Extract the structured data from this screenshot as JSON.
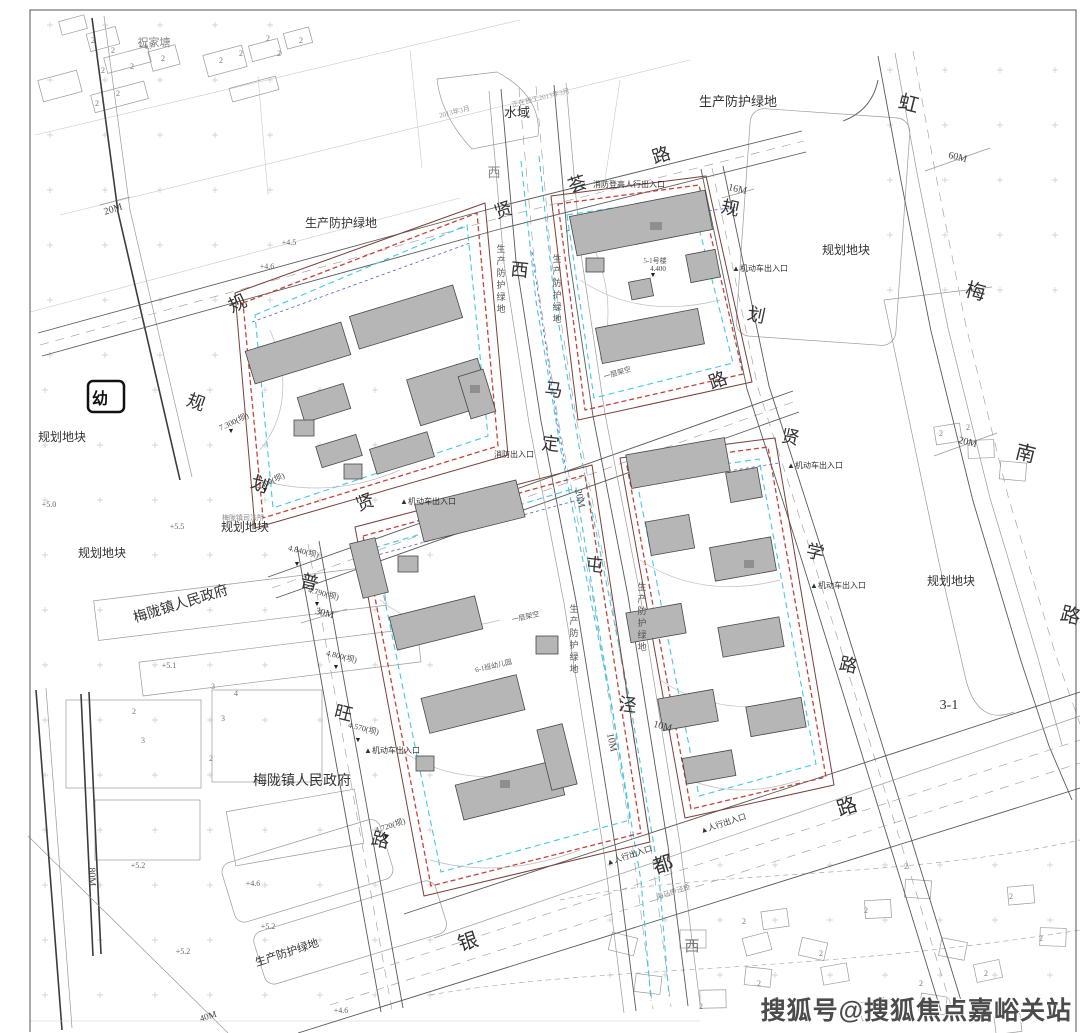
{
  "title": "住宅小区规划总平面图",
  "colors": {
    "ink": "#333333",
    "red": "#c0453a",
    "boundary": "#7a4038",
    "cyan": "#45c7e2",
    "blue": "#4a5fd0",
    "bfill": "#b6b6b6",
    "bstroke": "#474747",
    "road": "#5a5a5a",
    "ctx": "#9a9a9a",
    "faint": "#c9c9c9",
    "frame": "#555555",
    "wm": "#4b4b4b"
  },
  "watermark": {
    "text": "搜狐号@搜狐焦点嘉峪关站"
  },
  "kindergarten_marker": {
    "label": "幼"
  },
  "map": {
    "labels": {
      "road_name_characters": [
        {
          "t": "贤",
          "x": 505,
          "y": 216,
          "s": 18,
          "rot": -18
        },
        {
          "t": "荟",
          "x": 579,
          "y": 190,
          "s": 18,
          "rot": -18
        },
        {
          "t": "路",
          "x": 663,
          "y": 161,
          "s": 18,
          "rot": -18
        },
        {
          "t": "西",
          "x": 494,
          "y": 177,
          "s": 13,
          "c": "#888888"
        },
        {
          "t": "西",
          "x": 519,
          "y": 276,
          "s": 18,
          "rot": 6
        },
        {
          "t": "马",
          "x": 553,
          "y": 396,
          "s": 18,
          "rot": 6
        },
        {
          "t": "定",
          "x": 550,
          "y": 450,
          "s": 18,
          "rot": 6
        },
        {
          "t": "屯",
          "x": 594,
          "y": 571,
          "s": 18,
          "rot": 6
        },
        {
          "t": "泾",
          "x": 627,
          "y": 711,
          "s": 18,
          "rot": 6
        },
        {
          "t": "规",
          "x": 729,
          "y": 214,
          "s": 18,
          "rot": 12
        },
        {
          "t": "划",
          "x": 755,
          "y": 321,
          "s": 18,
          "rot": 12
        },
        {
          "t": "路",
          "x": 720,
          "y": 386,
          "s": 18,
          "rot": -20
        },
        {
          "t": "贤",
          "x": 789,
          "y": 443,
          "s": 18,
          "rot": 12
        },
        {
          "t": "学",
          "x": 814,
          "y": 558,
          "s": 18,
          "rot": 12
        },
        {
          "t": "路",
          "x": 847,
          "y": 671,
          "s": 18,
          "rot": 12
        },
        {
          "t": "贤",
          "x": 367,
          "y": 508,
          "s": 18,
          "rot": -20
        },
        {
          "t": "普",
          "x": 308,
          "y": 588,
          "s": 18,
          "rot": 14
        },
        {
          "t": "旺",
          "x": 342,
          "y": 719,
          "s": 18,
          "rot": 14
        },
        {
          "t": "路",
          "x": 379,
          "y": 846,
          "s": 18,
          "rot": 14
        },
        {
          "t": "规",
          "x": 240,
          "y": 309,
          "s": 18,
          "rot": -25
        },
        {
          "t": "规",
          "x": 194,
          "y": 408,
          "s": 18,
          "rot": 20
        },
        {
          "t": "划",
          "x": 258,
          "y": 490,
          "s": 18,
          "rot": 20
        },
        {
          "t": "虹",
          "x": 907,
          "y": 110,
          "s": 20,
          "rot": 14
        },
        {
          "t": "梅",
          "x": 974,
          "y": 298,
          "s": 20,
          "rot": 14
        },
        {
          "t": "南",
          "x": 1024,
          "y": 460,
          "s": 20,
          "rot": 14
        },
        {
          "t": "路",
          "x": 1069,
          "y": 622,
          "s": 20,
          "rot": 14
        },
        {
          "t": "银",
          "x": 470,
          "y": 948,
          "s": 20,
          "rot": -18
        },
        {
          "t": "都",
          "x": 665,
          "y": 871,
          "s": 20,
          "rot": -18
        },
        {
          "t": "路",
          "x": 849,
          "y": 813,
          "s": 20,
          "rot": -18
        },
        {
          "t": "西",
          "x": 692,
          "y": 951,
          "s": 15,
          "c": "#777777"
        }
      ],
      "area_labels": [
        {
          "t": "水域",
          "x": 517,
          "y": 117,
          "s": 13
        },
        {
          "t": "生产防护绿地",
          "x": 738,
          "y": 106,
          "s": 13
        },
        {
          "t": "生产防护绿地",
          "x": 341,
          "y": 227,
          "s": 12
        },
        {
          "t": "规划地块",
          "x": 62,
          "y": 441,
          "s": 12
        },
        {
          "t": "规划地块",
          "x": 102,
          "y": 557,
          "s": 12
        },
        {
          "t": "规划地块",
          "x": 245,
          "y": 531,
          "s": 12
        },
        {
          "t": "规划地块",
          "x": 846,
          "y": 254,
          "s": 12
        },
        {
          "t": "规划地块",
          "x": 951,
          "y": 585,
          "s": 12
        },
        {
          "t": "祝家塘",
          "x": 154,
          "y": 46,
          "s": 11,
          "c": "#888888"
        },
        {
          "t": "梅陇镇人民政府",
          "x": 182,
          "y": 608,
          "s": 14,
          "rot": -17
        },
        {
          "t": "梅陇镇人民政府",
          "x": 302,
          "y": 785,
          "s": 14
        },
        {
          "t": "生产防护绿地",
          "x": 288,
          "y": 956,
          "s": 11,
          "rot": -18
        },
        {
          "t": "3-1",
          "x": 949,
          "y": 709,
          "s": 14
        }
      ],
      "dimensions": [
        {
          "t": "20M",
          "x": 114,
          "y": 212,
          "s": 10,
          "rot": -18,
          "c": "#444444"
        },
        {
          "t": "60M",
          "x": 957,
          "y": 160,
          "s": 10,
          "rot": 14,
          "c": "#444444"
        },
        {
          "t": "20M",
          "x": 967,
          "y": 445,
          "s": 10,
          "rot": 14,
          "c": "#444444"
        },
        {
          "t": "16M",
          "x": 737,
          "y": 192,
          "s": 10,
          "rot": 12,
          "c": "#444444"
        },
        {
          "t": "30M",
          "x": 324,
          "y": 616,
          "s": 10,
          "rot": 14,
          "c": "#444444"
        },
        {
          "t": "20M",
          "x": 577,
          "y": 499,
          "s": 10,
          "rot": 78,
          "c": "#444444"
        },
        {
          "t": "10M",
          "x": 609,
          "y": 743,
          "s": 10,
          "rot": 78,
          "c": "#444444"
        },
        {
          "t": "10M",
          "x": 662,
          "y": 729,
          "s": 10,
          "rot": 14,
          "c": "#444444"
        },
        {
          "t": "80M",
          "x": 89,
          "y": 877,
          "s": 10,
          "rot": 88,
          "c": "#444444"
        },
        {
          "t": "40M",
          "x": 209,
          "y": 1019,
          "s": 9,
          "rot": -18,
          "c": "#444444"
        }
      ],
      "entrances": [
        {
          "t": "▲机动车出入口",
          "x": 760,
          "y": 271,
          "s": 8
        },
        {
          "t": "▲机动车出入口",
          "x": 815,
          "y": 468,
          "s": 8
        },
        {
          "t": "▲机动车出入口",
          "x": 838,
          "y": 588,
          "s": 8
        },
        {
          "t": "▲机动车出入口",
          "x": 428,
          "y": 504,
          "s": 8
        },
        {
          "t": "▲机动车出入口",
          "x": 392,
          "y": 753,
          "s": 8
        },
        {
          "t": "▲人行出入口",
          "x": 630,
          "y": 858,
          "s": 8,
          "rot": -18
        },
        {
          "t": "▲人行出入口",
          "x": 724,
          "y": 826,
          "s": 8,
          "rot": -18
        },
        {
          "t": "消防登高人行出入口",
          "x": 629,
          "y": 187,
          "s": 8
        },
        {
          "t": "消防出入口",
          "x": 514,
          "y": 457,
          "s": 8
        }
      ],
      "spot_elevations": [
        {
          "t": "+4.5",
          "x": 289,
          "y": 245,
          "s": 8,
          "c": "#666666"
        },
        {
          "t": "+4.6",
          "x": 267,
          "y": 269,
          "s": 8,
          "c": "#666666"
        },
        {
          "t": "+4.7",
          "x": 146,
          "y": 49,
          "s": 8,
          "c": "#666666"
        },
        {
          "t": "+5.0",
          "x": 49,
          "y": 507,
          "s": 8,
          "c": "#666666"
        },
        {
          "t": "+5.5",
          "x": 177,
          "y": 529,
          "s": 8,
          "c": "#666666"
        },
        {
          "t": "+5.1",
          "x": 169,
          "y": 668,
          "s": 8,
          "c": "#666666"
        },
        {
          "t": "+5.2",
          "x": 138,
          "y": 868,
          "s": 8,
          "c": "#666666"
        },
        {
          "t": "+5.2",
          "x": 268,
          "y": 929,
          "s": 8,
          "c": "#666666"
        },
        {
          "t": "+5.2",
          "x": 183,
          "y": 954,
          "s": 8,
          "c": "#666666"
        },
        {
          "t": "+4.6",
          "x": 253,
          "y": 886,
          "s": 8,
          "c": "#666666"
        },
        {
          "t": "+4.6",
          "x": 341,
          "y": 1013,
          "s": 8,
          "c": "#666666"
        }
      ],
      "benchmarks": [
        {
          "t": "4.840(坝)",
          "x": 303,
          "y": 554,
          "s": 8,
          "rot": 14,
          "c": "#444444"
        },
        {
          "t": "4.790(坝)",
          "x": 323,
          "y": 596,
          "s": 8,
          "rot": 14,
          "c": "#444444"
        },
        {
          "t": "4.800(坝)",
          "x": 341,
          "y": 659,
          "s": 8,
          "rot": 14,
          "c": "#444444"
        },
        {
          "t": "4.570(坝)",
          "x": 363,
          "y": 731,
          "s": 8,
          "rot": 14,
          "c": "#444444"
        },
        {
          "t": "4.720(坝)",
          "x": 391,
          "y": 828,
          "s": 8,
          "rot": -18,
          "c": "#444444"
        },
        {
          "t": "7.300(坝)",
          "x": 235,
          "y": 424,
          "s": 8,
          "rot": -25,
          "c": "#444444"
        },
        {
          "t": "5.300(坝)",
          "x": 271,
          "y": 484,
          "s": 8,
          "rot": -25,
          "c": "#444444"
        },
        {
          "t": "4.400",
          "x": 658,
          "y": 271,
          "s": 7,
          "c": "#444444"
        },
        {
          "t": "▼",
          "x": 297,
          "y": 566,
          "s": 7,
          "c": "#222222"
        },
        {
          "t": "▼",
          "x": 317,
          "y": 606,
          "s": 7,
          "c": "#222222"
        },
        {
          "t": "▼",
          "x": 336,
          "y": 669,
          "s": 7,
          "c": "#222222"
        },
        {
          "t": "▼",
          "x": 358,
          "y": 742,
          "s": 7,
          "c": "#222222"
        },
        {
          "t": "▼",
          "x": 386,
          "y": 839,
          "s": 7,
          "c": "#222222"
        },
        {
          "t": "▼",
          "x": 231,
          "y": 433,
          "s": 7,
          "c": "#222222"
        },
        {
          "t": "▼",
          "x": 265,
          "y": 492,
          "s": 7,
          "c": "#222222"
        },
        {
          "t": "▼",
          "x": 653,
          "y": 277,
          "s": 7,
          "c": "#222222"
        }
      ],
      "story_numbers": [
        {
          "t": "2",
          "x": 93,
          "y": 43,
          "s": 8,
          "c": "#777777"
        },
        {
          "t": "2",
          "x": 113,
          "y": 53,
          "s": 8,
          "c": "#777777"
        },
        {
          "t": "2",
          "x": 132,
          "y": 69,
          "s": 8,
          "c": "#777777"
        },
        {
          "t": "2",
          "x": 163,
          "y": 61,
          "s": 8,
          "c": "#777777"
        },
        {
          "t": "2",
          "x": 221,
          "y": 63,
          "s": 8,
          "c": "#777777"
        },
        {
          "t": "2",
          "x": 241,
          "y": 56,
          "s": 8,
          "c": "#777777"
        },
        {
          "t": "2",
          "x": 268,
          "y": 41,
          "s": 8,
          "c": "#777777"
        },
        {
          "t": "2",
          "x": 279,
          "y": 56,
          "s": 8,
          "c": "#777777"
        },
        {
          "t": "2",
          "x": 301,
          "y": 43,
          "s": 8,
          "c": "#777777"
        },
        {
          "t": "2",
          "x": 103,
          "y": 73,
          "s": 8,
          "c": "#777777"
        },
        {
          "t": "2",
          "x": 118,
          "y": 96,
          "s": 8,
          "c": "#777777"
        },
        {
          "t": "2",
          "x": 97,
          "y": 106,
          "s": 8,
          "c": "#777777"
        },
        {
          "t": "2",
          "x": 134,
          "y": 714,
          "s": 8,
          "c": "#777777"
        },
        {
          "t": "3",
          "x": 213,
          "y": 689,
          "s": 8,
          "c": "#777777"
        },
        {
          "t": "3",
          "x": 223,
          "y": 721,
          "s": 8,
          "c": "#777777"
        },
        {
          "t": "4",
          "x": 236,
          "y": 696,
          "s": 8,
          "c": "#777777"
        },
        {
          "t": "3",
          "x": 143,
          "y": 743,
          "s": 8,
          "c": "#777777"
        },
        {
          "t": "2",
          "x": 211,
          "y": 761,
          "s": 8,
          "c": "#777777"
        },
        {
          "t": "2",
          "x": 744,
          "y": 924,
          "s": 8,
          "c": "#777777"
        },
        {
          "t": "2",
          "x": 759,
          "y": 986,
          "s": 8,
          "c": "#777777"
        },
        {
          "t": "2",
          "x": 821,
          "y": 956,
          "s": 8,
          "c": "#777777"
        },
        {
          "t": "2",
          "x": 866,
          "y": 913,
          "s": 8,
          "c": "#777777"
        },
        {
          "t": "2",
          "x": 906,
          "y": 869,
          "s": 8,
          "c": "#777777"
        },
        {
          "t": "2",
          "x": 941,
          "y": 436,
          "s": 8,
          "c": "#777777"
        },
        {
          "t": "2",
          "x": 1041,
          "y": 941,
          "s": 8,
          "c": "#777777"
        },
        {
          "t": "2",
          "x": 986,
          "y": 976,
          "s": 8,
          "c": "#777777"
        },
        {
          "t": "2",
          "x": 701,
          "y": 1009,
          "s": 8,
          "c": "#777777"
        },
        {
          "t": "2",
          "x": 921,
          "y": 986,
          "s": 8,
          "c": "#777777"
        },
        {
          "t": "2",
          "x": 1011,
          "y": 899,
          "s": 8,
          "c": "#777777"
        },
        {
          "t": "2",
          "x": 968,
          "y": 430,
          "s": 8,
          "c": "#777777"
        }
      ],
      "small_notes": [
        {
          "t": "正在施工2013年3月",
          "x": 541,
          "y": 100,
          "s": 7,
          "rot": -14,
          "c": "#999999"
        },
        {
          "t": "2013年3月",
          "x": 455,
          "y": 114,
          "s": 7,
          "rot": -14,
          "c": "#999999"
        },
        {
          "t": "梅陇镇司法所",
          "x": 243,
          "y": 520,
          "s": 7,
          "c": "#888888"
        },
        {
          "t": "5-1号楼",
          "x": 655,
          "y": 263,
          "s": 7,
          "c": "#555555"
        },
        {
          "t": "一层架空",
          "x": 618,
          "y": 375,
          "s": 7,
          "rot": -17,
          "c": "#555555"
        },
        {
          "t": "一层架空",
          "x": 526,
          "y": 619,
          "s": 7,
          "rot": -13,
          "c": "#555555"
        },
        {
          "t": "6-1班幼儿园",
          "x": 494,
          "y": 668,
          "s": 7,
          "rot": -13,
          "c": "#555555"
        },
        {
          "t": "海马申泾桥",
          "x": 674,
          "y": 894,
          "s": 7,
          "rot": -18,
          "c": "#888888"
        }
      ],
      "green_belt_vertical": [
        {
          "t": "生产防护绿地",
          "x": 501,
          "y": 252,
          "s": 9,
          "v": true,
          "c": "#555555"
        },
        {
          "t": "生产防护绿地",
          "x": 557,
          "y": 262,
          "s": 9,
          "v": true,
          "c": "#555555"
        },
        {
          "t": "生产防护绿地",
          "x": 574,
          "y": 612,
          "s": 9,
          "v": true,
          "c": "#555555"
        },
        {
          "t": "生产防护绿地",
          "x": 642,
          "y": 590,
          "s": 9,
          "v": true,
          "c": "#555555"
        }
      ]
    }
  }
}
